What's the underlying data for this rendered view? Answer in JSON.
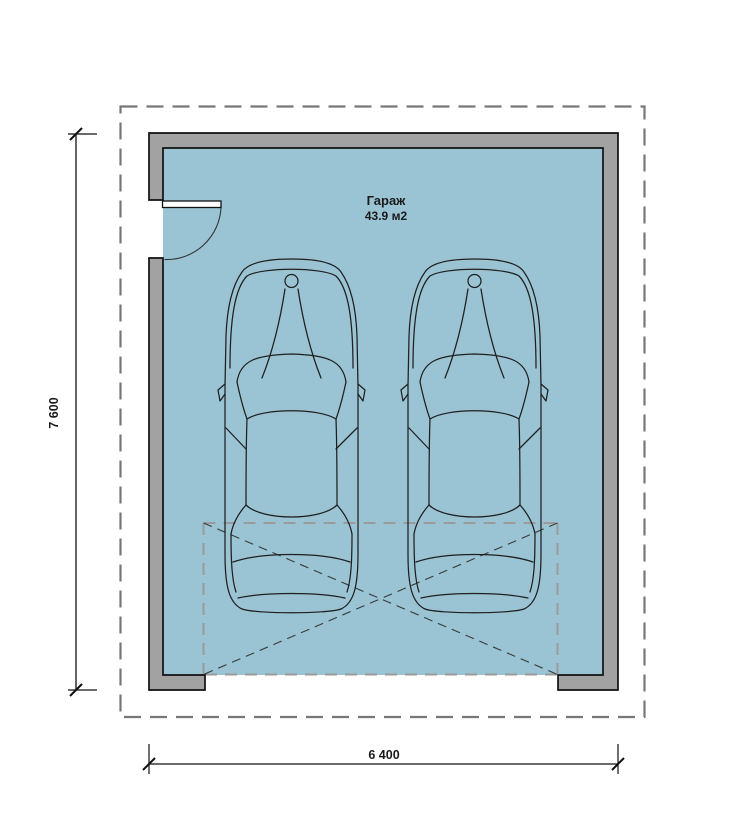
{
  "room": {
    "name": "Гараж",
    "area": "43.9 м2"
  },
  "dimensions": {
    "height": "7 600",
    "width": "6 400"
  },
  "objects": {
    "car_count": 2,
    "door": "swing-door-left-wall",
    "garage_opening": "dashed-x-zone-bottom"
  },
  "colors": {
    "floor": "#9ac4d3",
    "wall": "#a2a2a2",
    "outline": "#111111",
    "boundary": "#777777",
    "zone_dash": "#9a9a9a",
    "diagonal_dash": "#3a3a3a",
    "car_line": "#1f1f1f"
  }
}
